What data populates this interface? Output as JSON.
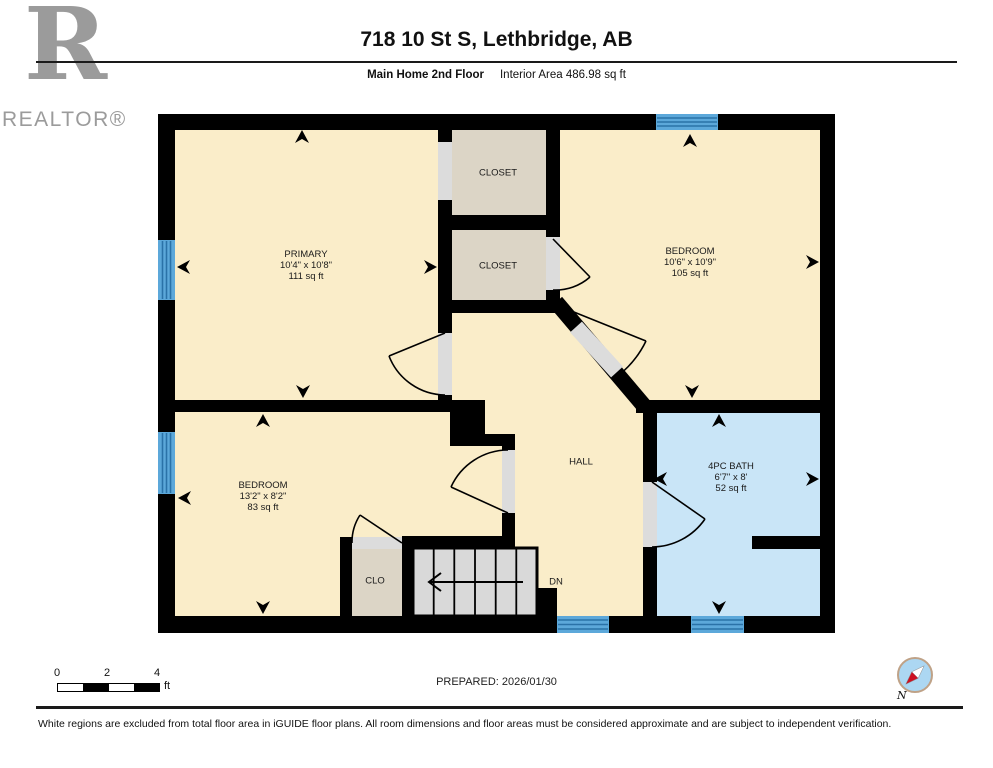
{
  "header": {
    "logo_letter": "R",
    "logo_label": "REALTOR®",
    "title": "718 10 St S, Lethbridge, AB",
    "floor_label": "Main Home 2nd Floor",
    "area_label": "Interior Area 486.98 sq ft"
  },
  "rooms": {
    "primary": {
      "name": "PRIMARY",
      "dims": "10'4\" x 10'8\"",
      "area": "111 sq ft"
    },
    "closet_top": {
      "name": "CLOSET"
    },
    "closet_mid": {
      "name": "CLOSET"
    },
    "bedroom_right": {
      "name": "BEDROOM",
      "dims": "10'6\" x 10'9\"",
      "area": "105 sq ft"
    },
    "bedroom_lower": {
      "name": "BEDROOM",
      "dims": "13'2\" x 8'2\"",
      "area": "83 sq ft"
    },
    "bath": {
      "name": "4PC BATH",
      "dims": "6'7\" x 8'",
      "area": "52 sq ft"
    },
    "hall": {
      "name": "HALL"
    },
    "clo": {
      "name": "CLO"
    },
    "stairs": {
      "label": "DN"
    }
  },
  "scale_bar": {
    "tick0": "0",
    "tick1": "2",
    "tick2": "4",
    "unit": "ft"
  },
  "prepared_label": "PREPARED: 2026/01/30",
  "compass_label": "N",
  "disclaimer": "White regions are excluded from total floor area in iGUIDE floor plans. All room dimensions and floor areas must be considered approximate and are subject to independent verification.",
  "colors": {
    "room_fill": "#FAEDC9",
    "closet_fill": "#DCD5C6",
    "bath_fill": "#C9E5F7",
    "stairs_fill": "#D9D9D9",
    "wall": "#000000",
    "window_fill": "#5CA8DA",
    "window_stripe": "#2A72A8",
    "door_opening": "#DCDCDC"
  }
}
